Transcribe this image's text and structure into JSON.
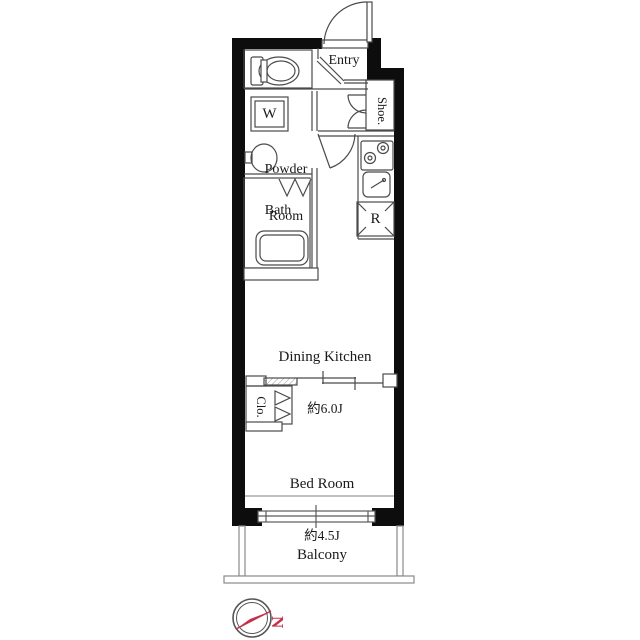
{
  "floorplan": {
    "labels": {
      "entry": "Entry",
      "shoe_closet": "Shoe.",
      "powder_room_line1": "Powder",
      "powder_room_line2": "Room",
      "washing_machine": "W",
      "bath": "Bath",
      "refrigerator": "R",
      "dining_kitchen_name": "Dining Kitchen",
      "dining_kitchen_size": "約6.0J",
      "closet": "Clo.",
      "bed_room_name": "Bed Room",
      "bed_room_size": "約4.5J",
      "balcony": "Balcony",
      "compass_north": "N"
    },
    "colors": {
      "wall": "#0d0d0d",
      "thin_line": "#4a4a4a",
      "light_line": "#8a8a8a",
      "compass_accent": "#c5314a"
    }
  }
}
